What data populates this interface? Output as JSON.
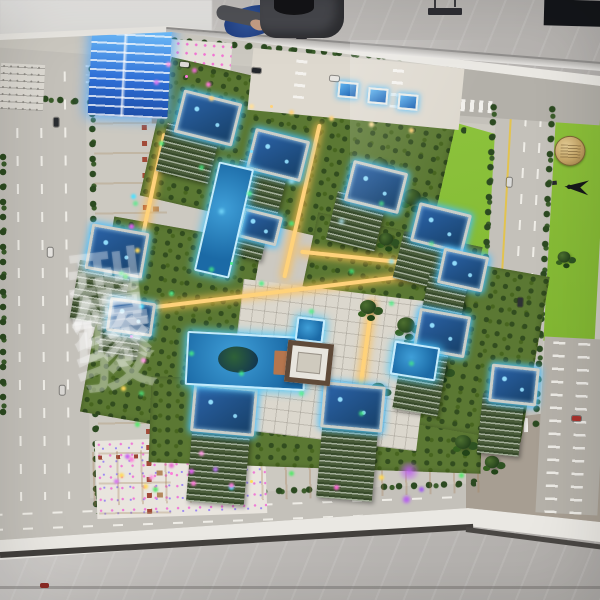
{
  "watermark": {
    "text": "骏绿模型",
    "chars": [
      "骏",
      "绿",
      "模",
      "型"
    ],
    "color": "rgba(255,255,255,0.24)"
  },
  "colors": {
    "led_blue": "#4fc3ff",
    "pool_blue": "#1b6aa6",
    "lawn_green": "#86bb35",
    "landscape_green": "#5b7833",
    "road_gray": "#c4c1ba",
    "marble_gray": "#bdbab6",
    "led_pink": "#ff7bd9",
    "path_warm": "#ffd27a",
    "medallion_gold": "#c5a566",
    "cloth_blue": "#1d3a7c"
  },
  "icons": [
    "compass-north-icon",
    "medallion-logo",
    "pendant-lamp-icon"
  ],
  "model": {
    "towers": [
      {
        "x": 90,
        "y": 22,
        "w": 80,
        "h": 95,
        "rot": 3,
        "type": "blueface"
      },
      {
        "x": 178,
        "y": 96,
        "w": 60,
        "h": 44,
        "rot": 14,
        "bh": 50,
        "bx": -8
      },
      {
        "x": 250,
        "y": 134,
        "w": 56,
        "h": 42,
        "rot": 14,
        "bh": 50,
        "bx": -8
      },
      {
        "x": 348,
        "y": 166,
        "w": 56,
        "h": 42,
        "rot": 14,
        "bh": 50,
        "bx": -8
      },
      {
        "x": 414,
        "y": 208,
        "w": 54,
        "h": 40,
        "rot": 14,
        "bh": 48,
        "bx": -8
      },
      {
        "x": 88,
        "y": 228,
        "w": 58,
        "h": 46,
        "rot": 10,
        "bh": 60,
        "bx": -6
      },
      {
        "x": 108,
        "y": 300,
        "w": 46,
        "h": 34,
        "rot": 8,
        "bh": 30,
        "bx": -5
      },
      {
        "x": 240,
        "y": 212,
        "w": 40,
        "h": 30,
        "rot": 14,
        "bh": 26,
        "bx": -5
      },
      {
        "x": 440,
        "y": 252,
        "w": 46,
        "h": 36,
        "rot": 12,
        "bh": 64,
        "bx": -9
      },
      {
        "x": 416,
        "y": 312,
        "w": 52,
        "h": 42,
        "rot": 10,
        "bh": 70,
        "bx": -10
      },
      {
        "x": 490,
        "y": 366,
        "w": 48,
        "h": 38,
        "rot": 6,
        "bh": 60,
        "bx": -6
      },
      {
        "x": 192,
        "y": 386,
        "w": 64,
        "h": 48,
        "rot": 5,
        "bh": 78,
        "bx": 2
      },
      {
        "x": 322,
        "y": 384,
        "w": 62,
        "h": 46,
        "rot": 5,
        "bh": 78,
        "bx": 2
      },
      {
        "x": 338,
        "y": 82,
        "w": 20,
        "h": 16,
        "rot": 5,
        "type": "canopy"
      },
      {
        "x": 368,
        "y": 88,
        "w": 20,
        "h": 16,
        "rot": 5,
        "type": "canopy"
      },
      {
        "x": 398,
        "y": 94,
        "w": 20,
        "h": 16,
        "rot": 5,
        "type": "canopy"
      }
    ],
    "pools": [
      {
        "x": 206,
        "y": 164,
        "w": 36,
        "h": 112,
        "rot": 13
      },
      {
        "x": 186,
        "y": 334,
        "w": 120,
        "h": 54,
        "rot": 3,
        "island": true,
        "deck": true
      },
      {
        "x": 392,
        "y": 344,
        "w": 46,
        "h": 34,
        "rot": 9
      },
      {
        "x": 296,
        "y": 318,
        "w": 28,
        "h": 24,
        "rot": 7
      }
    ],
    "bushes": [
      {
        "x": 372,
        "y": 158,
        "s": 1
      },
      {
        "x": 404,
        "y": 190,
        "s": 1.1
      },
      {
        "x": 378,
        "y": 232,
        "s": 0.9
      },
      {
        "x": 420,
        "y": 252,
        "s": 1.2
      },
      {
        "x": 360,
        "y": 300,
        "s": 1
      },
      {
        "x": 398,
        "y": 318,
        "s": 1.1
      },
      {
        "x": 432,
        "y": 362,
        "s": 1
      },
      {
        "x": 370,
        "y": 382,
        "s": 0.9
      },
      {
        "x": 452,
        "y": 300,
        "s": 0.8
      },
      {
        "x": 455,
        "y": 435,
        "s": 1
      },
      {
        "x": 484,
        "y": 455,
        "s": 0.9
      },
      {
        "x": 556,
        "y": 250,
        "s": 0.8
      }
    ],
    "cars": [
      {
        "x": 252,
        "y": 68,
        "rot": 4,
        "c": "#23262b"
      },
      {
        "x": 330,
        "y": 76,
        "rot": 4,
        "c": "#e8e6e2"
      },
      {
        "x": 180,
        "y": 62,
        "rot": 4,
        "c": "#dddbd7"
      },
      {
        "x": 52,
        "y": 120,
        "rot": 90,
        "c": "#2a2d31"
      },
      {
        "x": 46,
        "y": 250,
        "rot": 90,
        "c": "#e6e4e0"
      },
      {
        "x": 58,
        "y": 388,
        "rot": 90,
        "c": "#d8d6d2"
      },
      {
        "x": 505,
        "y": 180,
        "rot": 93,
        "c": "#dadad8"
      },
      {
        "x": 516,
        "y": 300,
        "rot": 93,
        "c": "#2e3135"
      },
      {
        "x": 444,
        "y": 519,
        "rot": -2,
        "c": "#b03028"
      },
      {
        "x": 248,
        "y": 531,
        "rot": -2,
        "c": "#e8e6e3"
      },
      {
        "x": 572,
        "y": 416,
        "rot": 3,
        "c": "#a8322c"
      }
    ]
  }
}
